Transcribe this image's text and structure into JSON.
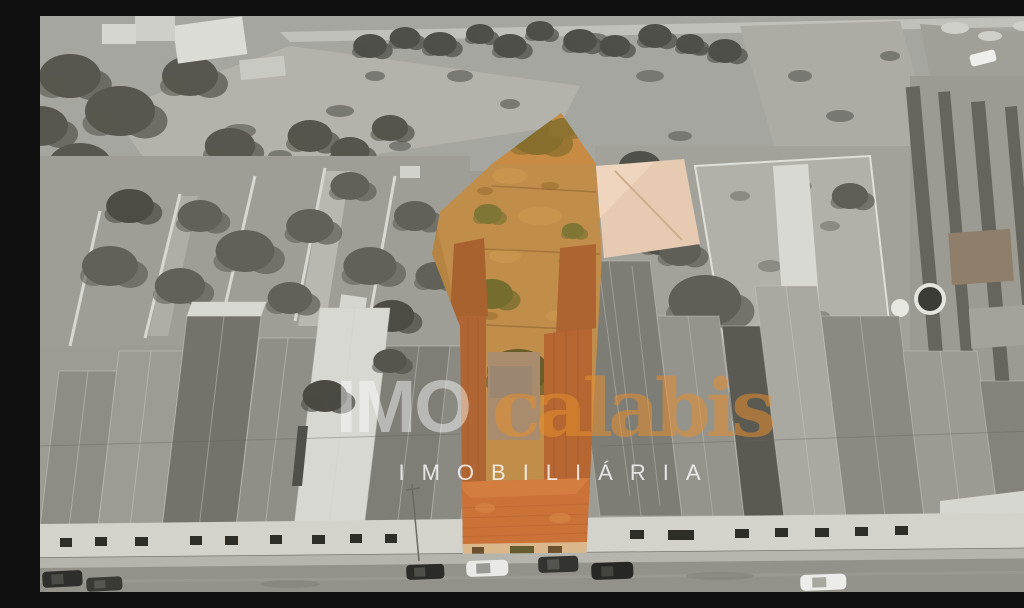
{
  "watermark": {
    "brand_first": "IMO",
    "brand_second": "calabis",
    "tagline": "IMOBILIÁRIA"
  },
  "colors": {
    "highlight_overlay": "#e0862c",
    "terracotta_roof": "#c06a3e",
    "lot_ground": "#b29158",
    "lot_tree_green": "#3f5c30",
    "watermark_white": "#ffffff",
    "watermark_orange": "#e68e2e",
    "grayscale_base": "#9c9c95",
    "street_asphalt": "#92928b"
  }
}
